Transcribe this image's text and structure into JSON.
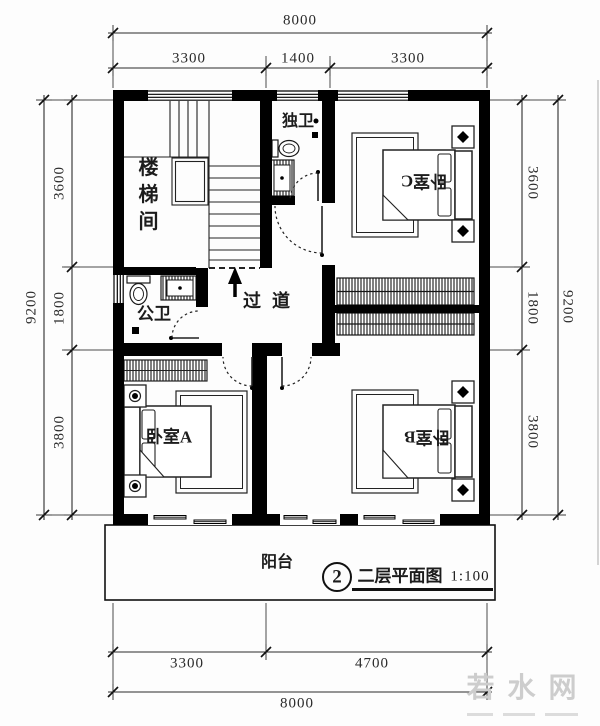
{
  "colors": {
    "wall": "#000000",
    "line": "#1f1f1f",
    "dimension_line": "#3a3a3a",
    "watermark": "#cdcdcd"
  },
  "dimensions": {
    "top": {
      "total": "8000",
      "segments": [
        "3300",
        "1400",
        "3300"
      ]
    },
    "bottom": {
      "total": "8000",
      "segments": [
        "3300",
        "4700"
      ]
    },
    "left": {
      "total": "9200",
      "segments": [
        "3600",
        "1800",
        "3800"
      ]
    },
    "right": {
      "total": "9200",
      "segments": [
        "3600",
        "1800",
        "3800"
      ]
    }
  },
  "rooms": {
    "stairwell": "楼梯间",
    "ensuite_bath": "独卫",
    "bedroom_c": "卧室C",
    "public_bath": "公卫",
    "hallway": "过道",
    "bedroom_a": "卧室A",
    "bedroom_b": "卧室B",
    "balcony": "阳台"
  },
  "title_block": {
    "figure_number": "2",
    "title": "二层平面图",
    "scale": "1:100"
  },
  "watermark": {
    "text": "若水网"
  }
}
